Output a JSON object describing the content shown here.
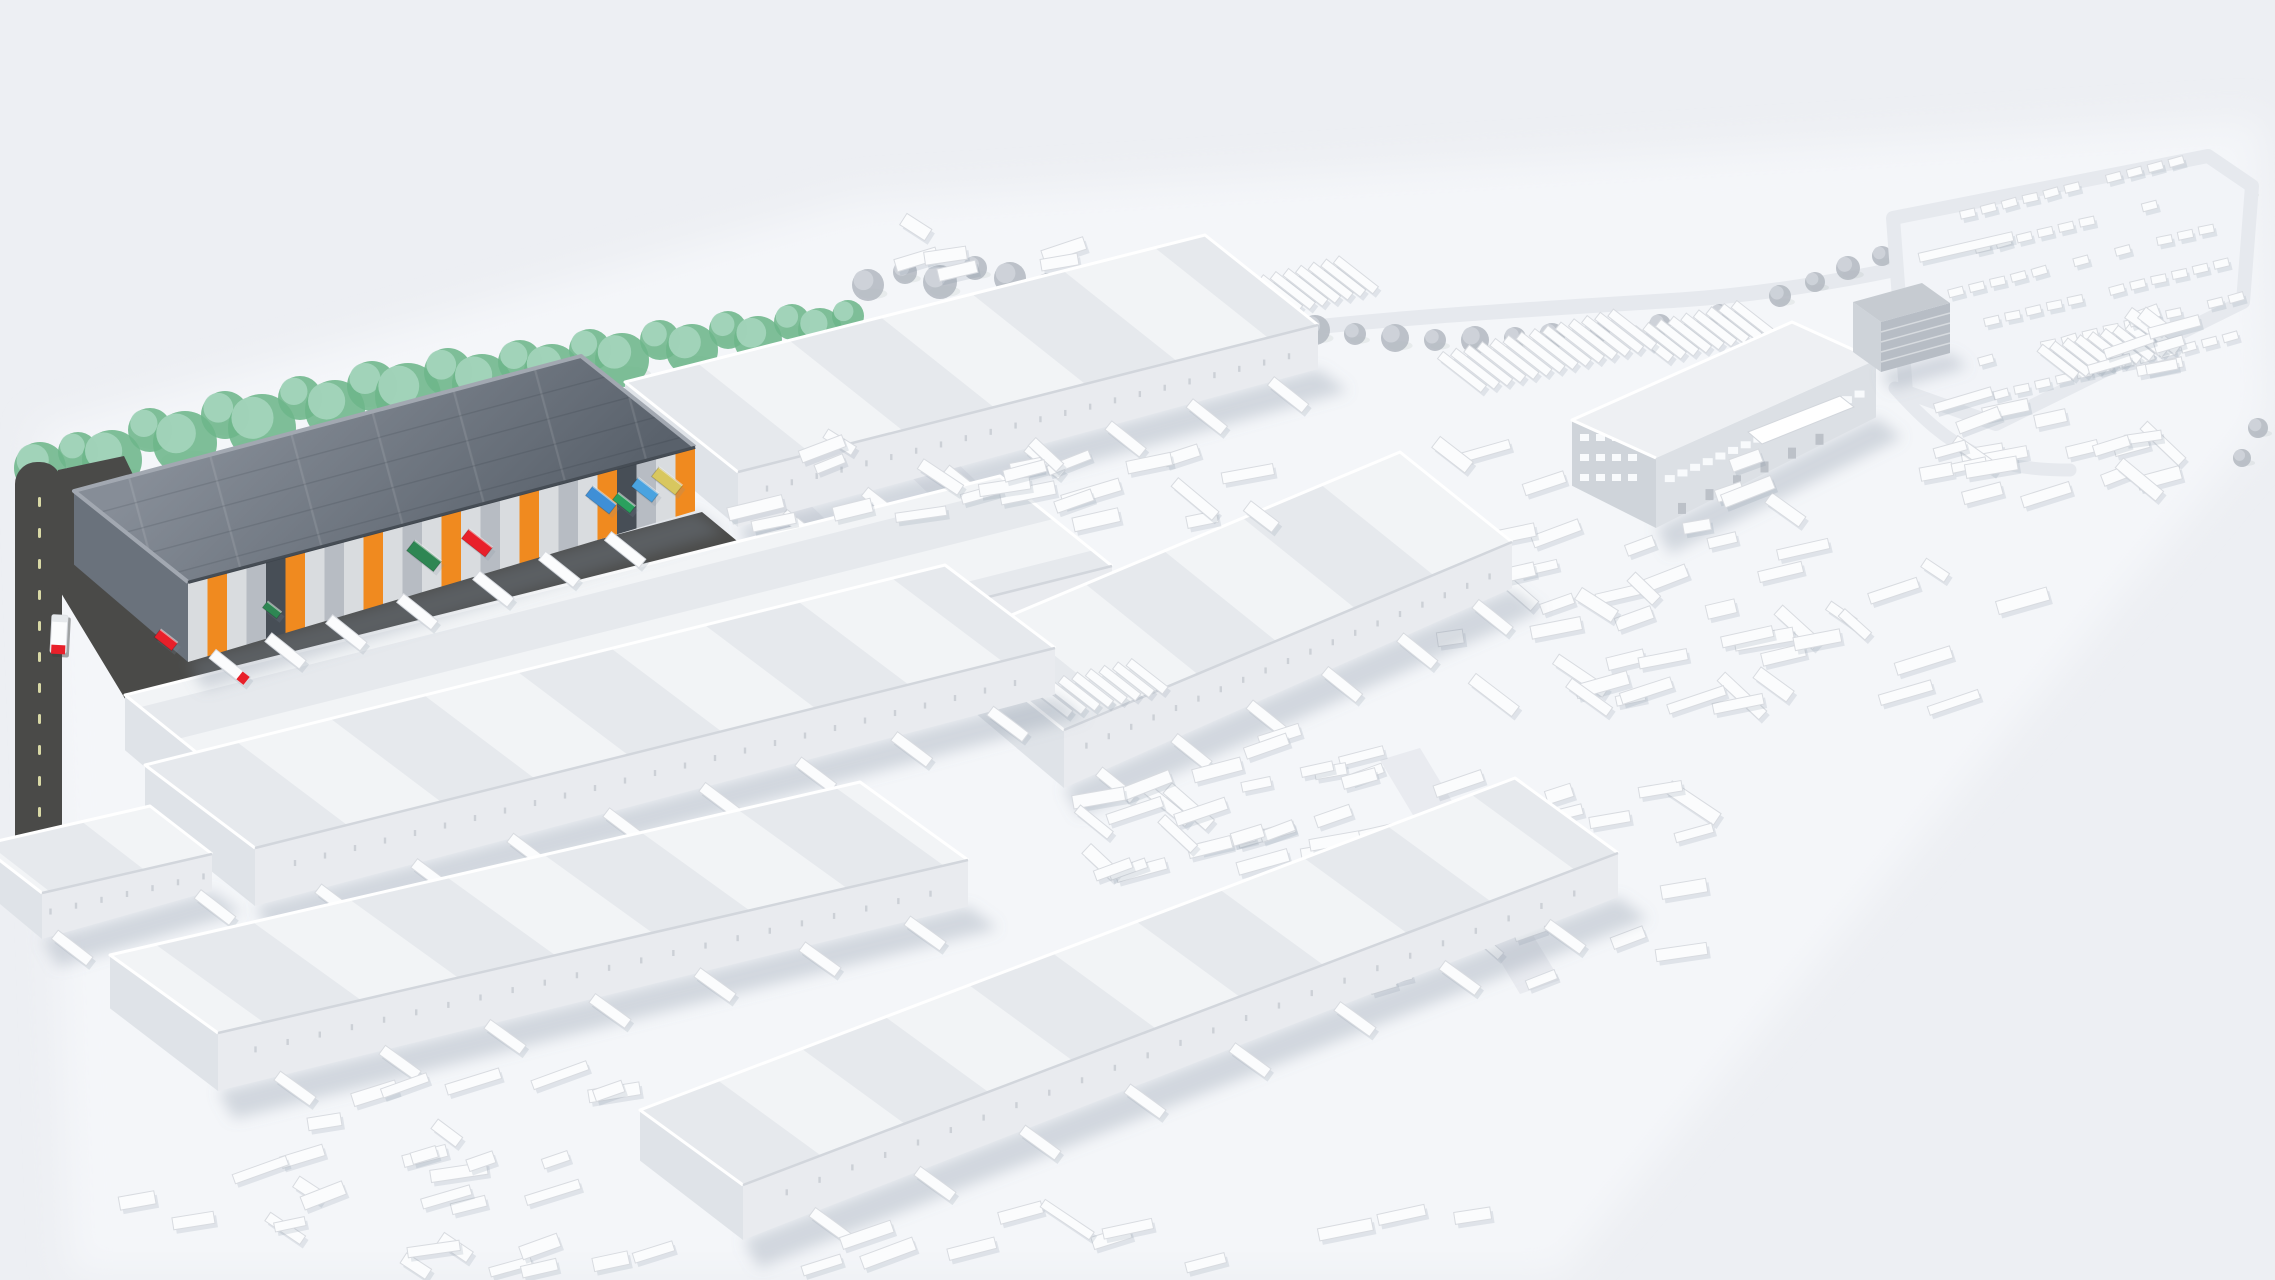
{
  "scene": {
    "width": 2275,
    "height": 1280,
    "background": "#edeff3",
    "label": "aerial-3d-illustration-of-logistics-park-with-highlighted-warehouse"
  },
  "palette": {
    "ground": "#f4f6f9",
    "roof_light_a": "#f2f4f6",
    "roof_light_b": "#e6e9ed",
    "parapet": "#ffffff",
    "eave": "#d2d6dc",
    "facade_white": "#e9ebef",
    "gable_white": "#dfe3e8",
    "shadow": "rgba(130,142,160,0.30)",
    "soft_shadow": "rgba(130,142,160,0.18)",
    "dark_roof_a": "#868d97",
    "dark_roof_b": "#59616b",
    "dark_gable": "#6a727c",
    "dark_trim": "#3e454d",
    "dark_parapet": "#a2a8b1",
    "door_light": "#d9dcdf",
    "door_mid": "#b7bcc3",
    "door_dark": "#474e56",
    "accent_orange": "#f08a1f",
    "asphalt": "#4a4a48",
    "dash": "#d9d9a6",
    "tree_green_a": "#6db68a",
    "tree_green_b": "#a5d5bc",
    "tree_gray_a": "#b4bac2",
    "tree_gray_b": "#cfd4da",
    "vehicle": "#fbfcfd",
    "vehicle_stroke": "#d8dbe0",
    "road_light": "#e6e9ee",
    "lot_fill": "#f2f4f8",
    "window": "#f8fafc",
    "office_wall": "#dce0e5",
    "office_side": "#cfd4da",
    "box_roof": "#c6cbd1",
    "box_front": "#b7bdc5",
    "box_side": "#ced3d9",
    "truck_red": "#e8202a"
  },
  "seed": 7,
  "ground_poly": [
    [
      40,
      430
    ],
    [
      860,
      200
    ],
    [
      2260,
      120
    ],
    [
      2268,
      420
    ],
    [
      1560,
      1275
    ],
    [
      70,
      1275
    ]
  ],
  "light_roads": [
    [
      [
        904,
        470
      ],
      [
        952,
        458
      ],
      [
        1205,
        700
      ],
      [
        1157,
        714
      ]
    ],
    [
      [
        700,
        456
      ],
      [
        746,
        444
      ],
      [
        976,
        662
      ],
      [
        930,
        676
      ]
    ],
    [
      [
        1380,
        760
      ],
      [
        1420,
        748
      ],
      [
        1560,
        980
      ],
      [
        1520,
        994
      ]
    ]
  ],
  "curve_roads": [
    {
      "d": "M 1245 335 C 1380 318 1520 310 1680 300 C 1800 292 1950 262 2040 232",
      "w": 15
    },
    {
      "d": "M 1895 388 C 1950 450 1990 470 2070 470",
      "w": 13
    }
  ],
  "parking": {
    "loop": [
      [
        1893,
        218
      ],
      [
        2208,
        156
      ],
      [
        2252,
        186
      ],
      [
        2243,
        302
      ],
      [
        1996,
        424
      ],
      [
        1906,
        392
      ]
    ],
    "rows": 6,
    "cars_per_row": 13,
    "origin": [
      1926,
      224
    ],
    "row_step": [
      15,
      34
    ],
    "car_step": 21.5,
    "angle": -14,
    "car_len": 15,
    "car_w": 8
  },
  "train": {
    "x": 1966,
    "y": 247,
    "len": 96,
    "w": 9,
    "angle": -13
  },
  "trees_green": [
    [
      40,
      468,
      26
    ],
    [
      78,
      452,
      20
    ],
    [
      112,
      460,
      30
    ],
    [
      150,
      430,
      22
    ],
    [
      185,
      443,
      32
    ],
    [
      225,
      415,
      24
    ],
    [
      262,
      428,
      34
    ],
    [
      300,
      398,
      22
    ],
    [
      335,
      410,
      30
    ],
    [
      372,
      386,
      25
    ],
    [
      408,
      396,
      33
    ],
    [
      448,
      372,
      24
    ],
    [
      482,
      384,
      30
    ],
    [
      520,
      362,
      22
    ],
    [
      552,
      372,
      28
    ],
    [
      590,
      350,
      21
    ],
    [
      622,
      360,
      27
    ],
    [
      660,
      340,
      20
    ],
    [
      692,
      350,
      26
    ],
    [
      728,
      330,
      19
    ],
    [
      758,
      340,
      24
    ],
    [
      792,
      322,
      18
    ],
    [
      820,
      330,
      22
    ],
    [
      848,
      316,
      16
    ],
    [
      34,
      504,
      17
    ],
    [
      62,
      488,
      15
    ]
  ],
  "trees_gray": [
    [
      868,
      285,
      16
    ],
    [
      905,
      272,
      12
    ],
    [
      940,
      282,
      17
    ],
    [
      975,
      268,
      12
    ],
    [
      1010,
      278,
      16
    ],
    [
      1048,
      286,
      13
    ],
    [
      1085,
      292,
      17
    ],
    [
      1122,
      298,
      13
    ],
    [
      1160,
      305,
      16
    ],
    [
      1198,
      312,
      12
    ],
    [
      1236,
      318,
      15
    ],
    [
      1275,
      324,
      12
    ],
    [
      1315,
      330,
      15
    ],
    [
      1355,
      334,
      11
    ],
    [
      1395,
      338,
      14
    ],
    [
      1435,
      340,
      11
    ],
    [
      1475,
      340,
      14
    ],
    [
      1515,
      338,
      11
    ],
    [
      1552,
      336,
      13
    ],
    [
      1600,
      332,
      10
    ],
    [
      1660,
      325,
      11
    ],
    [
      1720,
      314,
      10
    ],
    [
      1780,
      296,
      11
    ],
    [
      1815,
      282,
      10
    ],
    [
      1848,
      268,
      12
    ],
    [
      1882,
      256,
      10
    ],
    [
      1918,
      246,
      12
    ],
    [
      1955,
      236,
      10
    ],
    [
      1990,
      228,
      12
    ],
    [
      2028,
      220,
      10
    ],
    [
      2065,
      213,
      12
    ],
    [
      2102,
      207,
      10
    ],
    [
      2140,
      201,
      12
    ],
    [
      2178,
      196,
      10
    ],
    [
      2215,
      192,
      11
    ],
    [
      2246,
      190,
      9
    ],
    [
      2258,
      428,
      10
    ],
    [
      2242,
      458,
      9
    ]
  ],
  "road": {
    "x": 15,
    "y": 462,
    "w": 47,
    "h": 447,
    "rx": 22,
    "connector": [
      [
        58,
        470
      ],
      [
        124,
        456
      ],
      [
        214,
        642
      ],
      [
        702,
        512
      ],
      [
        748,
        550
      ],
      [
        212,
        748
      ],
      [
        150,
        740
      ],
      [
        58,
        588
      ]
    ],
    "dash_x": 38,
    "dash_y0": 497,
    "dash_y1": 880,
    "dash_step": 31
  },
  "road_truck": {
    "x": 59,
    "y": 634,
    "angle": 3
  },
  "buildings": [
    {
      "id": "warehouse-north",
      "type": "white",
      "roof": [
        [
          625,
          382
        ],
        [
          1205,
          235
        ],
        [
          1318,
          325
        ],
        [
          738,
          472
        ]
      ],
      "fh": 55,
      "stripes": "cross",
      "docks": 7
    },
    {
      "id": "warehouse-mid-left",
      "type": "white",
      "roof": [
        [
          125,
          695
        ],
        [
          1000,
          476
        ],
        [
          1112,
          566
        ],
        [
          237,
          785
        ]
      ],
      "fh": 60,
      "stripes": "long",
      "docks": 8
    },
    {
      "id": "warehouse-mid-right",
      "type": "white",
      "roof": [
        [
          952,
          640
        ],
        [
          1400,
          452
        ],
        [
          1512,
          542
        ],
        [
          1064,
          730
        ]
      ],
      "fh": 58,
      "stripes": "cross",
      "docks": 6
    },
    {
      "id": "highlighted-warehouse",
      "type": "dark",
      "roof": [
        [
          74,
          491
        ],
        [
          581,
          356
        ],
        [
          695,
          447
        ],
        [
          188,
          582
        ]
      ],
      "fh": 80,
      "doors": 26,
      "dock_ts": [
        0.05,
        0.16,
        0.28,
        0.42,
        0.57,
        0.7,
        0.83
      ]
    },
    {
      "id": "warehouse-south-1",
      "type": "white",
      "roof": [
        [
          145,
          765
        ],
        [
          945,
          565
        ],
        [
          1055,
          648
        ],
        [
          255,
          848
        ]
      ],
      "fh": 58,
      "stripes": "cross",
      "docks": 8
    },
    {
      "id": "shed-west",
      "type": "white",
      "roof": [
        [
          -20,
          845
        ],
        [
          150,
          806
        ],
        [
          212,
          854
        ],
        [
          42,
          893
        ]
      ],
      "fh": 46,
      "stripes": "cross",
      "docks": 2
    },
    {
      "id": "warehouse-south-2",
      "type": "white",
      "roof": [
        [
          110,
          955
        ],
        [
          860,
          782
        ],
        [
          968,
          860
        ],
        [
          218,
          1033
        ]
      ],
      "fh": 58,
      "stripes": "cross",
      "docks": 7
    },
    {
      "id": "warehouse-south-3",
      "type": "white",
      "roof": [
        [
          640,
          1110
        ],
        [
          1515,
          778
        ],
        [
          1618,
          853
        ],
        [
          743,
          1185
        ]
      ],
      "fh": 55,
      "stripes": "cross",
      "docks": 8
    }
  ],
  "highlight_containers": [
    {
      "x": 424,
      "y": 556,
      "len": 34,
      "w": 13,
      "color": "#2e8653"
    },
    {
      "x": 477,
      "y": 543,
      "len": 30,
      "w": 12,
      "color": "#e8202a"
    },
    {
      "x": 601,
      "y": 500,
      "len": 30,
      "w": 12,
      "color": "#3f8fd6"
    },
    {
      "x": 624,
      "y": 503,
      "len": 22,
      "w": 9,
      "color": "#2aa05e"
    },
    {
      "x": 645,
      "y": 490,
      "len": 26,
      "w": 11,
      "color": "#4aa3e0"
    },
    {
      "x": 667,
      "y": 481,
      "len": 30,
      "w": 12,
      "color": "#d8c75f"
    },
    {
      "x": 166,
      "y": 640,
      "len": 22,
      "w": 10,
      "color": "#e8202a"
    },
    {
      "x": 272,
      "y": 610,
      "len": 18,
      "w": 8,
      "color": "#2e8653"
    }
  ],
  "office": {
    "roof": [
      [
        1572,
        420
      ],
      [
        1792,
        322
      ],
      [
        1876,
        360
      ],
      [
        1656,
        458
      ]
    ],
    "fh": 70,
    "win_row_v": 0.3,
    "win_cols": 16,
    "door_row_v": 0.72,
    "door_cols": 6,
    "canopy": [
      [
        1748,
        432
      ],
      [
        1840,
        396
      ],
      [
        1854,
        407
      ],
      [
        1762,
        444
      ]
    ],
    "gable_win_rows": 3,
    "gable_win_cols": 4
  },
  "box_building": {
    "roof": [
      [
        1853,
        302
      ],
      [
        1922,
        283
      ],
      [
        1950,
        303
      ],
      [
        1881,
        322
      ]
    ],
    "h": 50
  },
  "combs": [
    {
      "x": 1255,
      "y": 300,
      "n": 9,
      "step": 13,
      "len": 50,
      "w": 9,
      "angle": 38
    },
    {
      "x": 1462,
      "y": 372,
      "n": 14,
      "step": 13.5,
      "len": 55,
      "w": 9,
      "angle": 38
    },
    {
      "x": 1652,
      "y": 344,
      "n": 9,
      "step": 13,
      "len": 48,
      "w": 9,
      "angle": 38
    },
    {
      "x": 1052,
      "y": 700,
      "n": 8,
      "step": 14,
      "len": 46,
      "w": 9,
      "angle": 38
    },
    {
      "x": 2058,
      "y": 362,
      "n": 9,
      "step": 13,
      "len": 46,
      "w": 9,
      "angle": 38
    }
  ],
  "clutter": [
    {
      "x": 850,
      "y": 225,
      "w": 380,
      "h": 85,
      "n": 14
    },
    {
      "x": 1950,
      "y": 315,
      "w": 230,
      "h": 190,
      "n": 24
    },
    {
      "x": 755,
      "y": 430,
      "w": 580,
      "h": 95,
      "n": 24
    },
    {
      "x": 1450,
      "y": 445,
      "w": 580,
      "h": 270,
      "n": 60
    },
    {
      "x": 1120,
      "y": 735,
      "w": 260,
      "h": 130,
      "n": 16
    },
    {
      "x": 110,
      "y": 1075,
      "w": 600,
      "h": 195,
      "n": 34
    },
    {
      "x": 1085,
      "y": 770,
      "w": 620,
      "h": 230,
      "n": 46
    },
    {
      "x": 770,
      "y": 1205,
      "w": 720,
      "h": 60,
      "n": 12
    }
  ]
}
